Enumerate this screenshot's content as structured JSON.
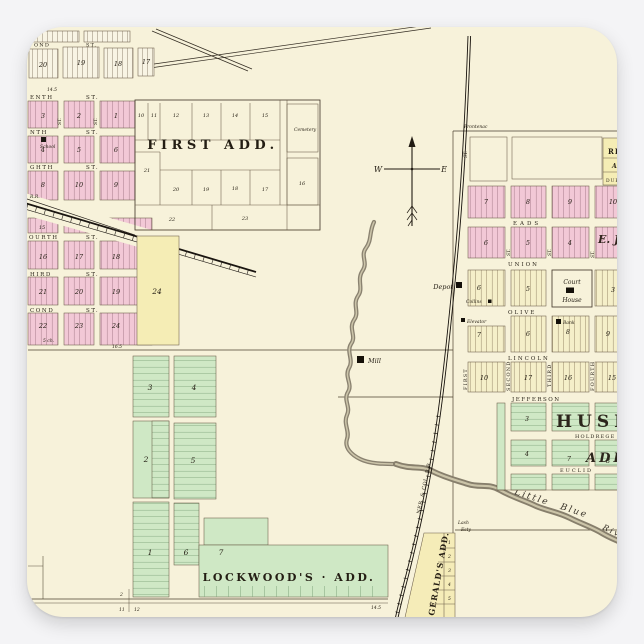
{
  "page": {
    "bg": "#f4f4f6",
    "paper": "#f7f2da"
  },
  "colors": {
    "pink": "#f2c8d6",
    "yellow": "#f5edb5",
    "green": "#cfe8c5",
    "court_green": "#bfe2b7",
    "ink": "#241e14"
  },
  "st": "ST.",
  "compass": {
    "w": "W",
    "e": "E"
  },
  "left_town": {
    "top_street": "OND",
    "top_blocks": [
      "20",
      "19",
      "18",
      "17"
    ],
    "streets": [
      "ENTH",
      "NTH",
      "GHTH",
      "OURTH",
      "HIRD",
      "COND"
    ],
    "r1": [
      "3",
      "2",
      "1"
    ],
    "r2": [
      "4",
      "5",
      "6"
    ],
    "r3": [
      "8",
      "10",
      "9"
    ],
    "b15": "15",
    "r4": [
      "16",
      "17",
      "18"
    ],
    "r5": [
      "21",
      "20",
      "19"
    ],
    "r6": [
      "22",
      "23",
      "24"
    ],
    "school": "School",
    "big24": "24",
    "rr": "R.R.",
    "ruler": "14.5",
    "note": "5 ch."
  },
  "first_add": {
    "title": "FIRST ADD.",
    "cemetery": "Cemetery",
    "row1": [
      "10",
      "11",
      "12",
      "13",
      "14",
      "15"
    ],
    "b21": "21",
    "row2": [
      "20",
      "19",
      "18",
      "17",
      "16"
    ],
    "b22": "22",
    "b23": "23"
  },
  "lockwood": {
    "title": "LOCKWOOD'S · ADD.",
    "b1": "1",
    "b2": "2",
    "b3": "3",
    "b4": "4",
    "b5": "5",
    "b6": "6",
    "b7": "7",
    "ruler": "16.5",
    "ruler2": "14.5"
  },
  "corner": {
    "n1": "2",
    "n2": "1",
    "n3": "11",
    "n4": "12"
  },
  "right_town": {
    "frontage": "Frontenac",
    "topright": [
      "RIC",
      "AD.",
      "DUF"
    ],
    "h_streets": [
      "EADS",
      "UNION",
      "OLIVE",
      "LINCOLN",
      "JEFFERSON",
      "HOLDREGE",
      "EUCLID"
    ],
    "v_streets": [
      "FIRST",
      "SECOND",
      "THIRD",
      "FOURTH"
    ],
    "r1": [
      "7",
      "8",
      "9",
      "10"
    ],
    "r2": [
      "6",
      "5",
      "4"
    ],
    "ej": "E. J",
    "r3": [
      "6",
      "5",
      "3"
    ],
    "r4": [
      "7",
      "6",
      "8",
      "9"
    ],
    "r5": [
      "10",
      "17",
      "16",
      "15"
    ],
    "court": {
      "l1": "Court",
      "l2": "House"
    },
    "depot": "Depot",
    "mill": "Mill",
    "elevator": "Elevator",
    "collins": "Collins",
    "bank": "Bank",
    "huse": {
      "title": "HUSE",
      "add": "ADD.",
      "b3": "3",
      "b4": "4",
      "b7": "7",
      "b8": "8"
    },
    "owner": {
      "a": "Lash",
      "b": "Esty"
    }
  },
  "rail": {
    "label": "NEB. & COL. R.R."
  },
  "river": {
    "a": "Little Blue",
    "b": "Riv."
  },
  "fitz": {
    "title": "GERALD'S ADD.",
    "lots": [
      "1",
      "2",
      "3",
      "4",
      "5"
    ]
  }
}
